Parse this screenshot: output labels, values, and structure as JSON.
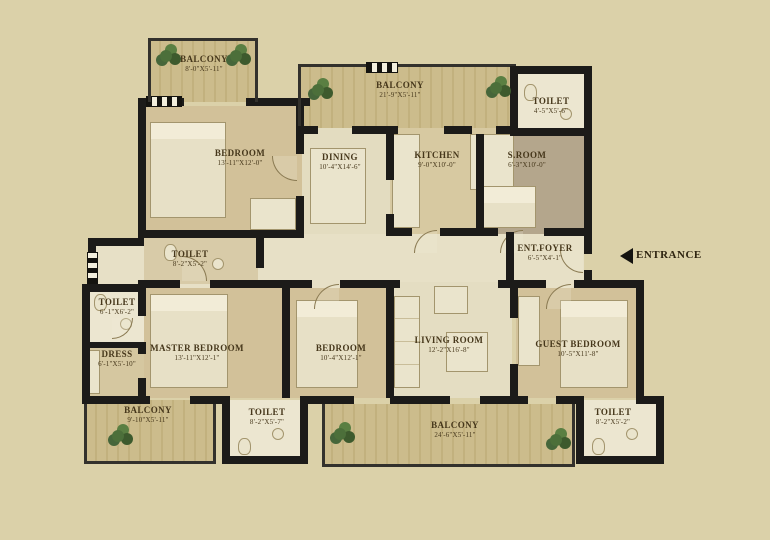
{
  "page": {
    "type": "apartment-floor-plan",
    "background": "#dbd1a9",
    "wall_color": "#1c1b19",
    "accent_green": "#4c6f3a",
    "text_color": "#46371b"
  },
  "entrance": {
    "label": "ENTRANCE",
    "arrow": "left"
  },
  "rooms": [
    {
      "id": "balcony-top-left",
      "name": "BALCONY",
      "dims": "8'-0\"X5'-11\""
    },
    {
      "id": "bedroom-top-left",
      "name": "BEDROOM",
      "dims": "13'-11\"X12'-0\""
    },
    {
      "id": "balcony-top",
      "name": "BALCONY",
      "dims": "21'-9\"X5'-11\""
    },
    {
      "id": "dining",
      "name": "DINING",
      "dims": "10'-4\"X14'-6\""
    },
    {
      "id": "kitchen",
      "name": "KITCHEN",
      "dims": "9'-0\"X10'-0\""
    },
    {
      "id": "toilet-top-right",
      "name": "TOILET",
      "dims": "4'-5\"X5'-6\""
    },
    {
      "id": "s-room",
      "name": "S.ROOM",
      "dims": "6'-3\"X10'-0\""
    },
    {
      "id": "ent-foyer",
      "name": "ENT.FOYER",
      "dims": "6'-5\"X4'-1\""
    },
    {
      "id": "toilet-master",
      "name": "TOILET",
      "dims": "8'-2\"X5'-2\""
    },
    {
      "id": "toilet-left",
      "name": "TOILET",
      "dims": "6'-1\"X6'-2\""
    },
    {
      "id": "dress",
      "name": "DRESS",
      "dims": "6'-1\"X5'-10\""
    },
    {
      "id": "master-bedroom",
      "name": "MASTER BEDROOM",
      "dims": "13'-11\"X12'-1\""
    },
    {
      "id": "bedroom-bottom",
      "name": "BEDROOM",
      "dims": "10'-4\"X12'-1\""
    },
    {
      "id": "living-room",
      "name": "LIVING ROOM",
      "dims": "12'-2\"X16'-8\""
    },
    {
      "id": "guest-bedroom",
      "name": "GUEST BEDROOM",
      "dims": "10'-5\"X11'-8\""
    },
    {
      "id": "balcony-bottom-left",
      "name": "BALCONY",
      "dims": "9'-10\"X5'-11\""
    },
    {
      "id": "toilet-bottom-mid",
      "name": "TOILET",
      "dims": "8'-2\"X5'-7\""
    },
    {
      "id": "balcony-bottom",
      "name": "BALCONY",
      "dims": "24'-6\"X5'-11\""
    },
    {
      "id": "toilet-bottom-right",
      "name": "TOILET",
      "dims": "8'-2\"X5'-2\""
    }
  ]
}
